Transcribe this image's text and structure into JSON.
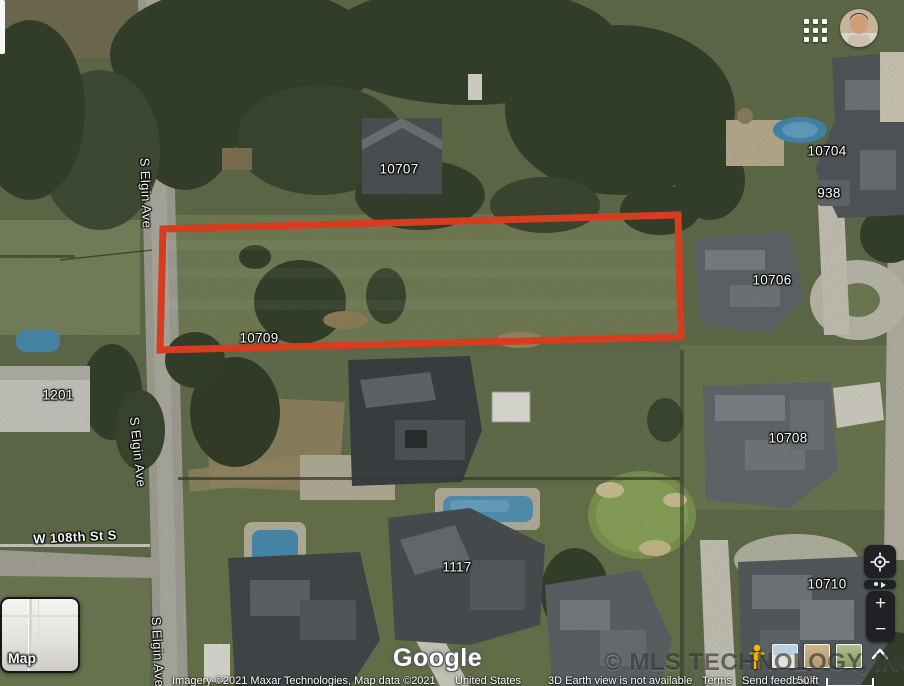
{
  "map": {
    "parcel_labels": [
      "10707",
      "10704",
      "938",
      "10706",
      "10709",
      "1201",
      "10708",
      "1117",
      "10710"
    ],
    "street_labels": [
      "S Elgin Ave",
      "S Elgin Ave",
      "S Elgin Ave",
      "W 108th St S"
    ]
  },
  "controls": {
    "map_toggle": "Map",
    "zoom_in": "+",
    "zoom_out": "−"
  },
  "watermarks": {
    "google": "Google",
    "mls": "© MLS TECHNOLOGY, INC 2025"
  },
  "attribution": {
    "credits": "Imagery ©2021 Maxar Technologies, Map data ©2021",
    "country": "United States",
    "notice": "3D Earth view is not available",
    "terms": "Terms",
    "send_feedback": "Send feedback",
    "scale": "50 ft"
  },
  "colors": {
    "parcel_outline": "#e8391b",
    "pool_water": "#4d8fb5",
    "control_background": "#1f2125",
    "pegman_yellow": "#f4b400"
  }
}
